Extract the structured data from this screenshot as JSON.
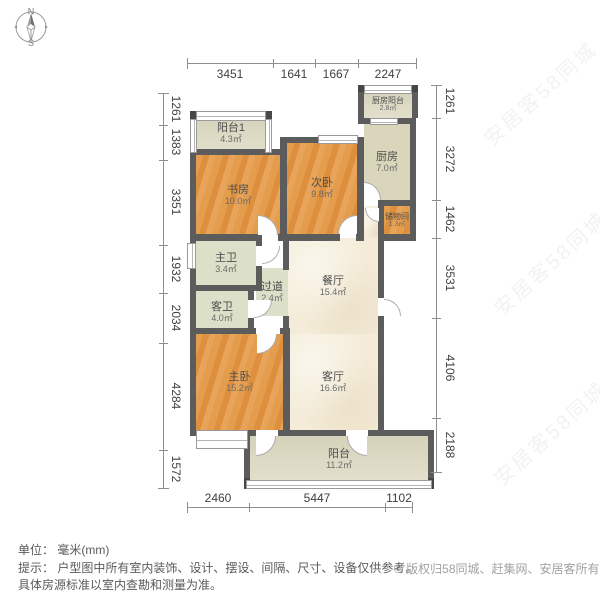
{
  "compass": {
    "north": "N",
    "south": "S"
  },
  "dimensions": {
    "top": [
      "3451",
      "1641",
      "1667",
      "2247"
    ],
    "bottom": [
      "2460",
      "5447",
      "1102"
    ],
    "left": [
      "1261",
      "1383",
      "3351",
      "1932",
      "2034",
      "4284",
      "1572"
    ],
    "right": [
      "1261",
      "3272",
      "1462",
      "3531",
      "4106",
      "2188"
    ]
  },
  "rooms": [
    {
      "name": "阳台1",
      "area": "4.3㎡"
    },
    {
      "name": "书房",
      "area": "10.0㎡"
    },
    {
      "name": "次卧",
      "area": "9.8㎡"
    },
    {
      "name": "厨房阳台",
      "area": "2.8㎡"
    },
    {
      "name": "厨房",
      "area": "7.0㎡"
    },
    {
      "name": "储物间",
      "area": "1.3㎡"
    },
    {
      "name": "主卫",
      "area": "3.4㎡"
    },
    {
      "name": "过道",
      "area": "2.4㎡"
    },
    {
      "name": "客卫",
      "area": "4.0㎡"
    },
    {
      "name": "餐厅",
      "area": "15.4㎡"
    },
    {
      "name": "主卧",
      "area": "15.2㎡"
    },
    {
      "name": "客厅",
      "area": "16.6㎡"
    },
    {
      "name": "阳台",
      "area": "11.2㎡"
    }
  ],
  "footer": {
    "unit": "单位： 毫米(mm)",
    "hint_line1": "提示： 户型图中所有室内装饰、设计、摆设、间隔、尺寸、设备仅供参考。",
    "hint_line2": "具体房源标准以室内查勘和测量为准。",
    "copyright": "© 版权归58同城、赶集网、安居客所有"
  },
  "watermark": {
    "text": "安居客58同城"
  },
  "colors": {
    "wall": "#5c5c5c",
    "wood_floor": "#e49c4d",
    "marble_floor": "#f4ecd8",
    "balcony_floor": "#dcd9c1",
    "dimension_text": "#3f3f3f"
  }
}
